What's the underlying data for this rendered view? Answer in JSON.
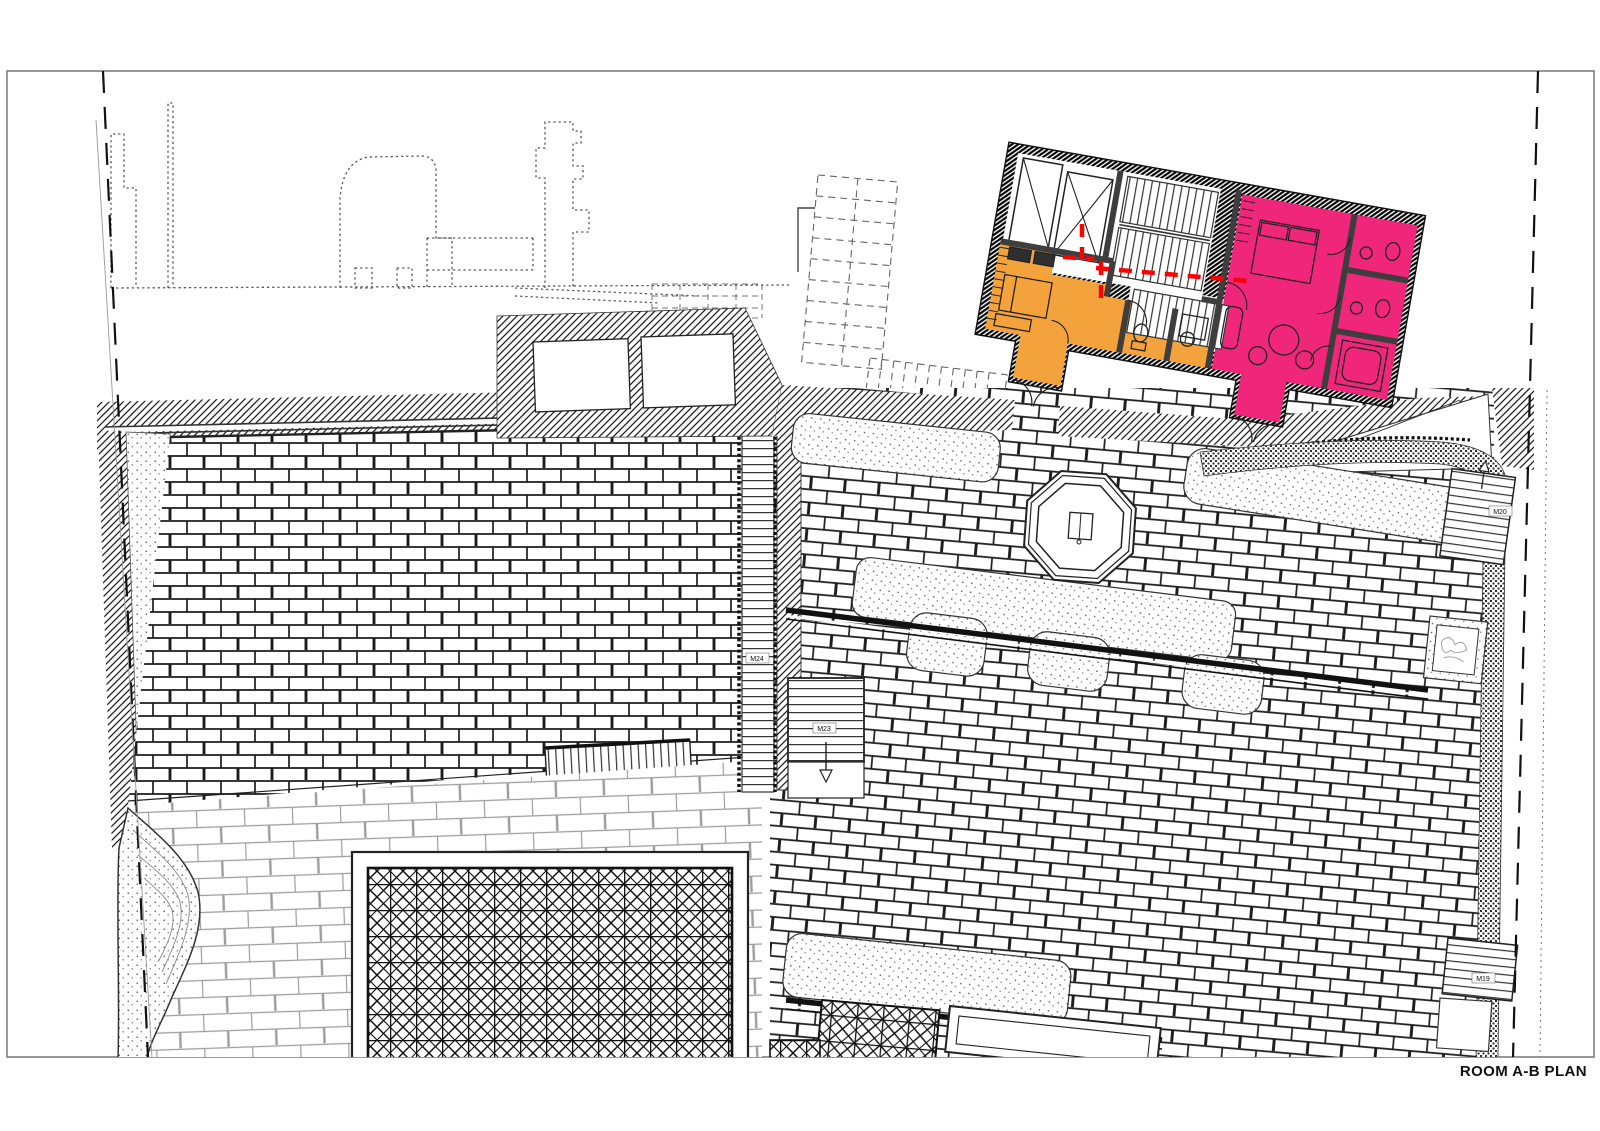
{
  "sheet": {
    "title": "ROOM A-B PLAN"
  },
  "labels": {
    "m24": "M24",
    "m23": "M23",
    "m20": "M20",
    "m19": "M19"
  },
  "colors": {
    "room_a": "#F4A23C",
    "room_b": "#F0267B",
    "section_line": "#FF0000",
    "wall": "#3F3F3F",
    "line": "#1A1A1A",
    "paper": "#FFFFFF"
  }
}
